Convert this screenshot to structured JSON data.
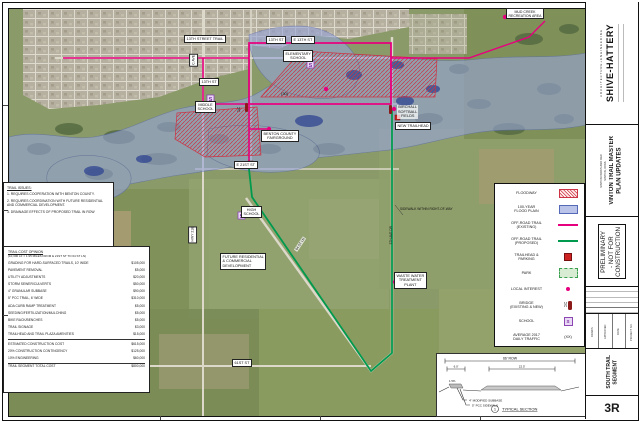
{
  "sheet": {
    "number": "3R",
    "firm": {
      "name": "SHIVE-HATTERY",
      "tagline": "ARCHITECTURE+ENGINEERING"
    },
    "project": {
      "title": "VINTON TRAIL MASTER\nPLAN UPDATES",
      "client": "VINTON PARKS AND REC",
      "location": "VINTON, IOWA"
    },
    "stamp": {
      "lines": [
        "PRELIMINARY",
        "- NOT FOR",
        "CONSTRUCTION"
      ]
    },
    "segment": "SOUTH TRAIL\nSEGMENT",
    "meta_labels": [
      "DRAWN",
      "APPROVED",
      "DATE",
      "PROJECT NO."
    ]
  },
  "issues": {
    "title": "TRAIL ISSUES:",
    "items": [
      "1. REQUIRES COOPERATION WITH BENTON COUNTY.",
      "2. REQUIRES COORDINATION WITH FUTURE RESIDENTIAL AND COMMERCIAL DEVELOPMENT.",
      "3. DRAINAGE EFFECTS OF PROPOSED TRAIL IN ROW"
    ]
  },
  "cost_table": {
    "title": "TRAIL COST OPINION",
    "subtitle": "(10,300 LF = 1.95 MILES FROM E 21ST ST TO 64 ST LN)",
    "rows": [
      {
        "label": "GRADING FOR HARD-SURFACED TRAILS, 10' WIDE",
        "value": "$105,000"
      },
      {
        "label": "PAVEMENT REMOVAL",
        "value": "$5,000"
      },
      {
        "label": "UTILITY ADJUSTMENTS",
        "value": "$20,000"
      },
      {
        "label": "STORM SEWER/CULVERTS",
        "value": "$50,000"
      },
      {
        "label": "4\" GRANULAR SUBBASE",
        "value": "$90,000"
      },
      {
        "label": "5\" PCC TRAIL, 6' WIDE",
        "value": "$310,000"
      },
      {
        "label": "ADA CURB RAMP TREATMENT",
        "value": "$5,000"
      },
      {
        "label": "SEEDING/FERTILIZATION/MULCHING",
        "value": "$5,000"
      },
      {
        "label": "BIKE RACK/BENCHES",
        "value": "$5,000"
      },
      {
        "label": "TRAIL SIGNAGE",
        "value": "$3,000"
      },
      {
        "label": "TRAILHEAD AND TRAIL PLAZA AMENITIES",
        "value": "$15,000"
      }
    ],
    "summary": [
      {
        "label": "ESTIMATED CONSTRUCTION COST",
        "value": "$615,000"
      },
      {
        "label": "20% CONSTRUCTION CONTINGENCY",
        "value": "$125,000"
      },
      {
        "label": "10% ENGINEERING",
        "value": "$60,000"
      },
      {
        "label": "TRAIL SEGMENT TOTAL COST",
        "value": "$800,000"
      }
    ]
  },
  "legend": {
    "traffic_symbol": "(XX)",
    "items": [
      {
        "label": "FLOODWAY",
        "symbol": "floodway"
      },
      {
        "label": "100-YEAR\nFLOOD PLAIN",
        "symbol": "floodplain"
      },
      {
        "label": "OFF-ROAD TRAIL\n(EXISTING)",
        "symbol": "line-magenta"
      },
      {
        "label": "OFF-ROAD TRAIL\n(PROPOSED)",
        "symbol": "line-green"
      },
      {
        "label": "TRAILHEAD &\nPARKING",
        "symbol": "trailhead"
      },
      {
        "label": "PARK",
        "symbol": "park"
      },
      {
        "label": "LOCAL INTEREST",
        "symbol": "dot"
      },
      {
        "label": "BRIDGE\n(EXISTING & NEW)",
        "symbol": "bridge"
      },
      {
        "label": "SCHOOL",
        "symbol": "school"
      },
      {
        "label": "AVERAGE 2017\nDAILY TRAFFIC",
        "symbol": "traffic"
      }
    ]
  },
  "section": {
    "row_dim": "66' ROW",
    "walk_dim": "6.0'",
    "pav_dim": "22.5'",
    "slope": "1.5%",
    "note_subbase": "4\" MODIFIED SUBBASE",
    "note_sidewalk": "5\" PCC SIDEWALK",
    "bubble": "1",
    "title": "TYPICAL SECTION"
  },
  "map": {
    "school_symbol": "S",
    "bridge_symbol": ")(",
    "traffic_note": "(30)",
    "labels": [
      {
        "text": "13TH STREET TRAIL"
      },
      {
        "text": "13TH ST"
      },
      {
        "text": "E 13TH ST"
      },
      {
        "text": "ELEMENTARY\nSCHOOL"
      },
      {
        "text": "13TH ST"
      },
      {
        "text": "C AVE"
      },
      {
        "text": "MIDDLE\nSCHOOL"
      },
      {
        "text": "BENTON COUNTY\nFAIRGROUND"
      },
      {
        "text": "BIRCHALL\nSOFTBALL\nFIELDS"
      },
      {
        "text": "NEW TRAILHEAD"
      },
      {
        "text": "MUD CREEK\nRECREATION AREA"
      },
      {
        "text": "E 21ST ST"
      },
      {
        "text": "HWY 218"
      },
      {
        "text": "HIGH\nSCHOOL"
      },
      {
        "text": "FUTURE RESIDENTIAL\n& COMMERCIAL\nDEVELOPMENT"
      },
      {
        "text": "SIDEWALK WITHIN RIGHT-OF-WAY"
      },
      {
        "text": "WASTE WATER\nTREATMENT\nPLANT"
      },
      {
        "text": "61ST ST"
      },
      {
        "text": "64 ST LN"
      },
      {
        "text": "5TH AVE DR"
      }
    ]
  },
  "colors": {
    "existing_trail": "#E6007E",
    "proposed_trail": "#009A4E",
    "floodway": "#CC3344",
    "flood_plain": "#96A4D8",
    "school": "#8B46B4",
    "trailhead": "#CC2222"
  }
}
